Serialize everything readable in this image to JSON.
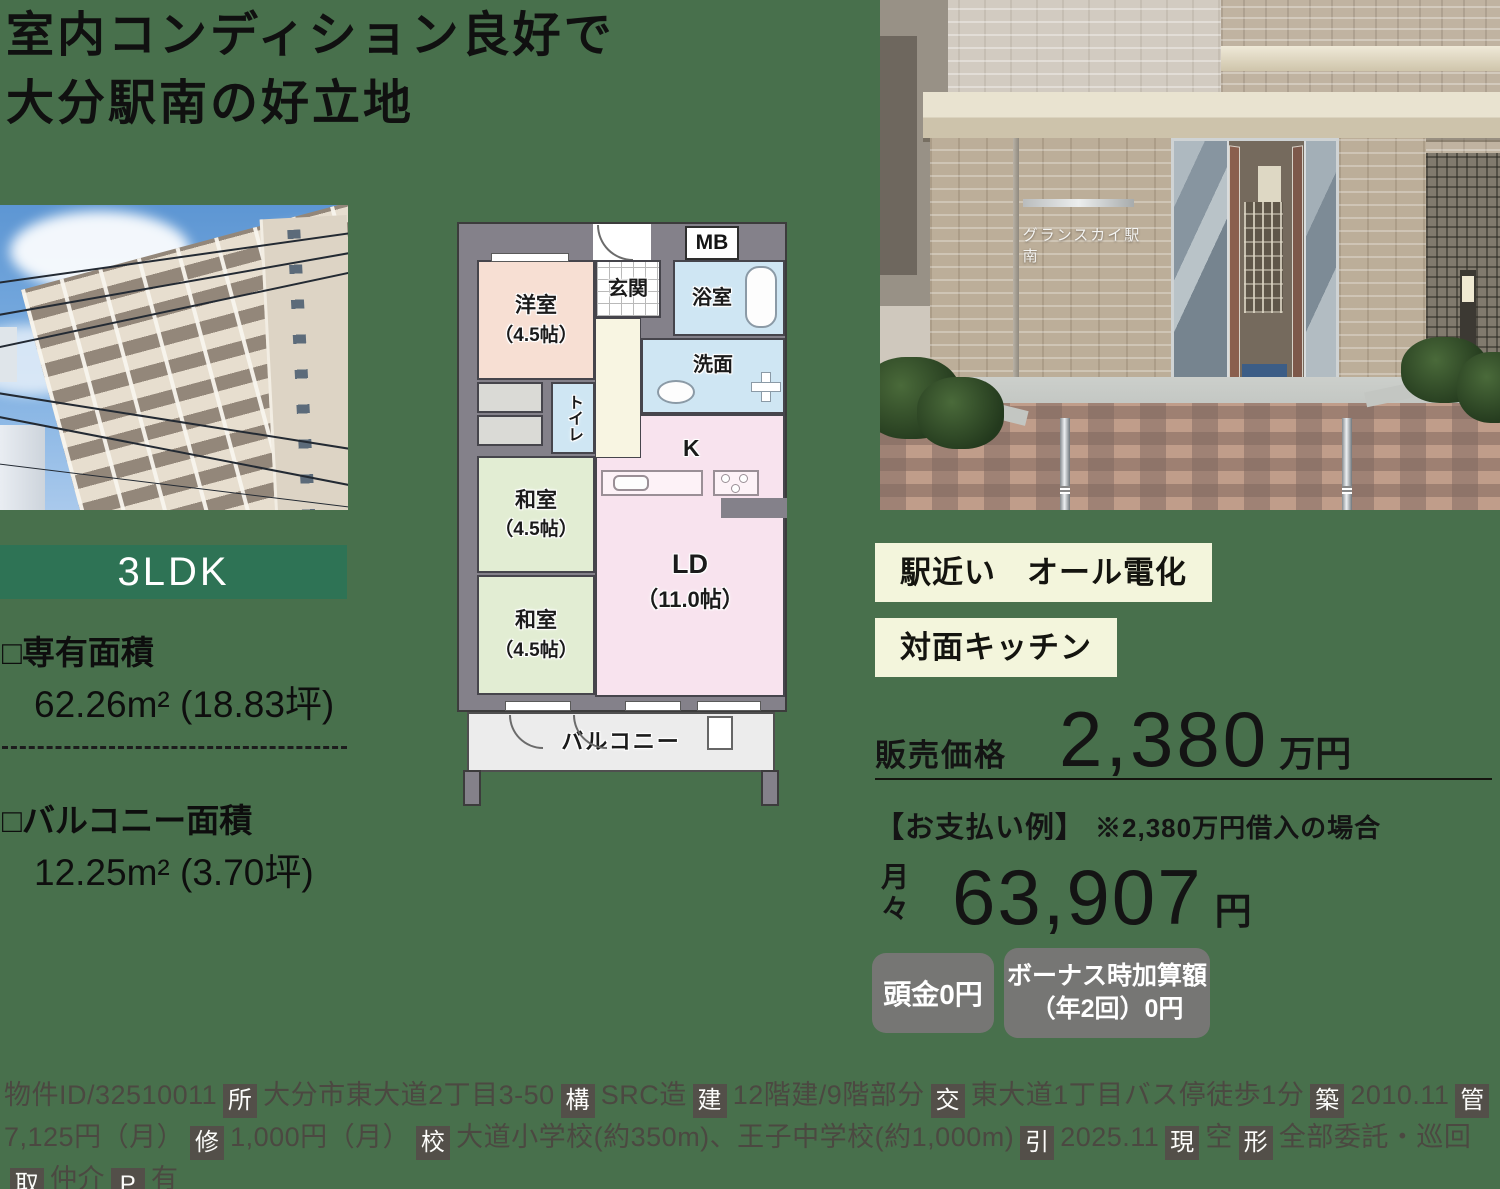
{
  "colors": {
    "background": "#48704c",
    "layout_badge_bg": "#2e7355",
    "tag_bg": "#f3f5dc",
    "pay_badge_bg": "#767674",
    "detail_box_bg": "#534f49"
  },
  "headline": {
    "line1": "室内コンディション良好で",
    "line2": "大分駅南の好立地"
  },
  "property": {
    "layout_badge": "3LDK",
    "exclusive_area_label": "□専有面積",
    "exclusive_area_value": "62.26m² (18.83坪)",
    "balcony_area_label": "□バルコニー面積",
    "balcony_area_value": "12.25m² (3.70坪)"
  },
  "photos": {
    "entrance_sign": "グランスカイ駅南"
  },
  "floorplan": {
    "mb": "MB",
    "entrance": "玄関",
    "bathroom": "浴室",
    "washroom": "洗面",
    "toilet": "トイレ",
    "kitchen": "K",
    "western_room": {
      "name": "洋室",
      "size": "（4.5帖）"
    },
    "japanese_room_1": {
      "name": "和室",
      "size": "（4.5帖）"
    },
    "japanese_room_2": {
      "name": "和室",
      "size": "（4.5帖）"
    },
    "living_dining": {
      "name": "LD",
      "size": "（11.0帖）"
    },
    "balcony": "バルコニー"
  },
  "tags": [
    {
      "label": "駅近い"
    },
    {
      "label": "オール電化"
    },
    {
      "label": "対面キッチン"
    }
  ],
  "price": {
    "label": "販売価格",
    "amount": "2,380",
    "unit": "万円"
  },
  "payment": {
    "heading": "【お支払い例】",
    "note": "※2,380万円借入の場合",
    "monthly_label": "月々",
    "monthly_amount": "63,907",
    "monthly_unit": "円",
    "badge1": "頭金0円",
    "badge2_line1": "ボーナス時加算額",
    "badge2_line2": "（年2回）0円"
  },
  "details": {
    "property_id": "物件ID/32510011",
    "items": [
      {
        "tag": "所",
        "text": "大分市東大道2丁目3-50"
      },
      {
        "tag": "構",
        "text": "SRC造"
      },
      {
        "tag": "建",
        "text": "12階建/9階部分"
      },
      {
        "tag": "交",
        "text": "東大道1丁目バス停徒歩1分"
      },
      {
        "tag": "築",
        "text": "2010.11"
      },
      {
        "tag": "管",
        "text": "7,125円（月）"
      },
      {
        "tag": "修",
        "text": "1,000円（月）"
      },
      {
        "tag": "校",
        "text": "大道小学校(約350m)、王子中学校(約1,000m)"
      },
      {
        "tag": "引",
        "text": "2025.11"
      },
      {
        "tag": "現",
        "text": "空"
      },
      {
        "tag": "形",
        "text": "全部委託・巡回"
      },
      {
        "tag": "取",
        "text": "仲介"
      },
      {
        "tag": "P",
        "text": "有"
      }
    ]
  }
}
